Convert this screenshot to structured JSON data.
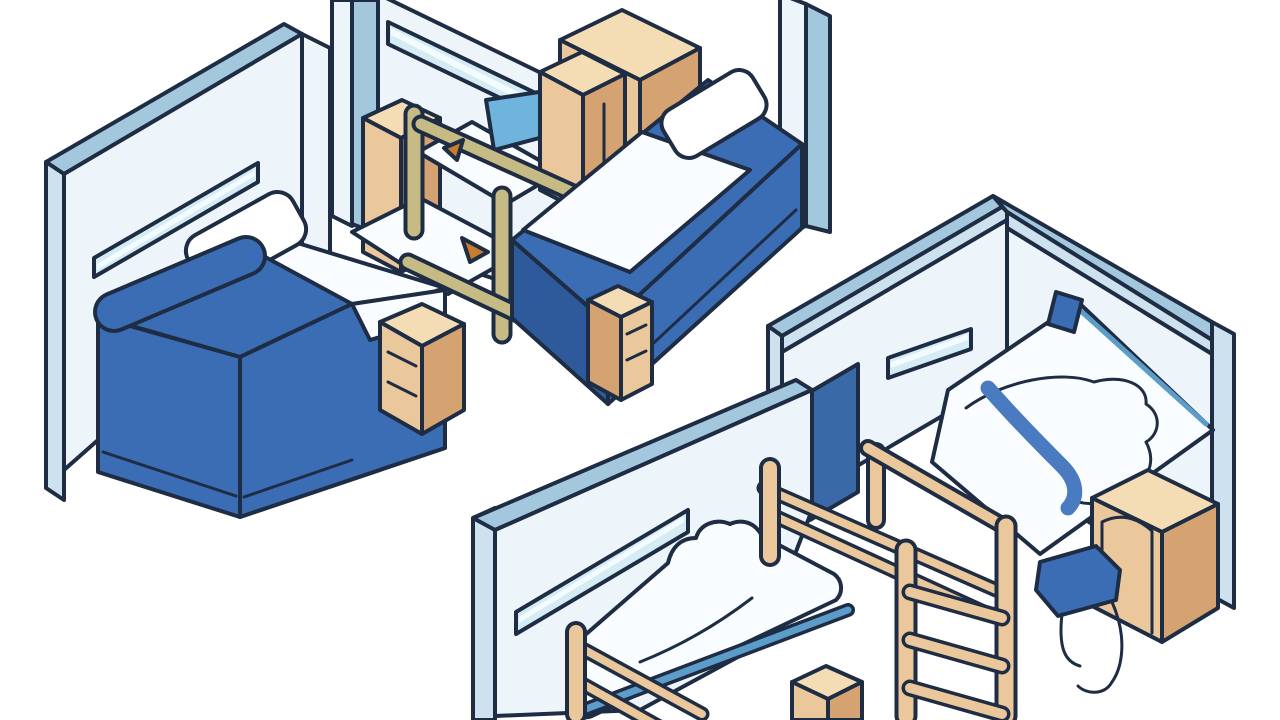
{
  "canvas": {
    "width": 1280,
    "height": 720,
    "background": "#ffffff"
  },
  "palette": {
    "outline": "#1e2c44",
    "wallTop": "#a3c8dd",
    "wallTopLight": "#cde2ee",
    "wallFace": "#eef5fa",
    "window": "#d5ecf5",
    "windowLight": "#f3fbff",
    "white": "#ffffff",
    "duvetWhite": "#fafdff",
    "blue": "#3b6db5",
    "blueDark": "#2e5a9c",
    "blueDeep": "#3a69a8",
    "skyBlue": "#6fb4dd",
    "skyBlueDeep": "#5b9cc8",
    "stripe": "#4a7abf",
    "wood": "#eac89b",
    "woodLight": "#f4dcb4",
    "woodDark": "#d5a271",
    "khaki": "#c6bb84",
    "accent": "#c87d2e",
    "background": "#ffffff"
  },
  "scenes": {
    "left_bedroom": {
      "label": "Bed with blue duvet, white pillow and wooden nightstand beside an L-shaped wall with a window slot",
      "items": [
        "wall",
        "window slot",
        "bed",
        "pillow",
        "blue duvet",
        "nightstand"
      ]
    },
    "middle_bedroom": {
      "label": "Dorm room with wardrobe, cabinets, wooden loft frame with khaki rails and a blue bed with white comforter",
      "items": [
        "left wall",
        "right wall",
        "window slot",
        "wardrobe",
        "cabinet",
        "nightstand",
        "loft frame",
        "bedding",
        "blue bed",
        "pillow",
        "footboard drawers"
      ]
    },
    "right_bedroom": {
      "label": "Corner room with white duvet bed with blue stripe, blue pillow, dark blue door, dresser and blue desk chair",
      "items": [
        "corner walls",
        "window slot",
        "door",
        "bed",
        "blue stripe",
        "blue pillow",
        "dresser",
        "desk chair",
        "wooden ladder shelf"
      ]
    },
    "front_bedroom": {
      "label": "Room with wooden-post bed, white duvet and small wooden nightstand",
      "items": [
        "wall",
        "window slot",
        "post bed",
        "white duvet",
        "mattress edge",
        "nightstand"
      ]
    }
  }
}
